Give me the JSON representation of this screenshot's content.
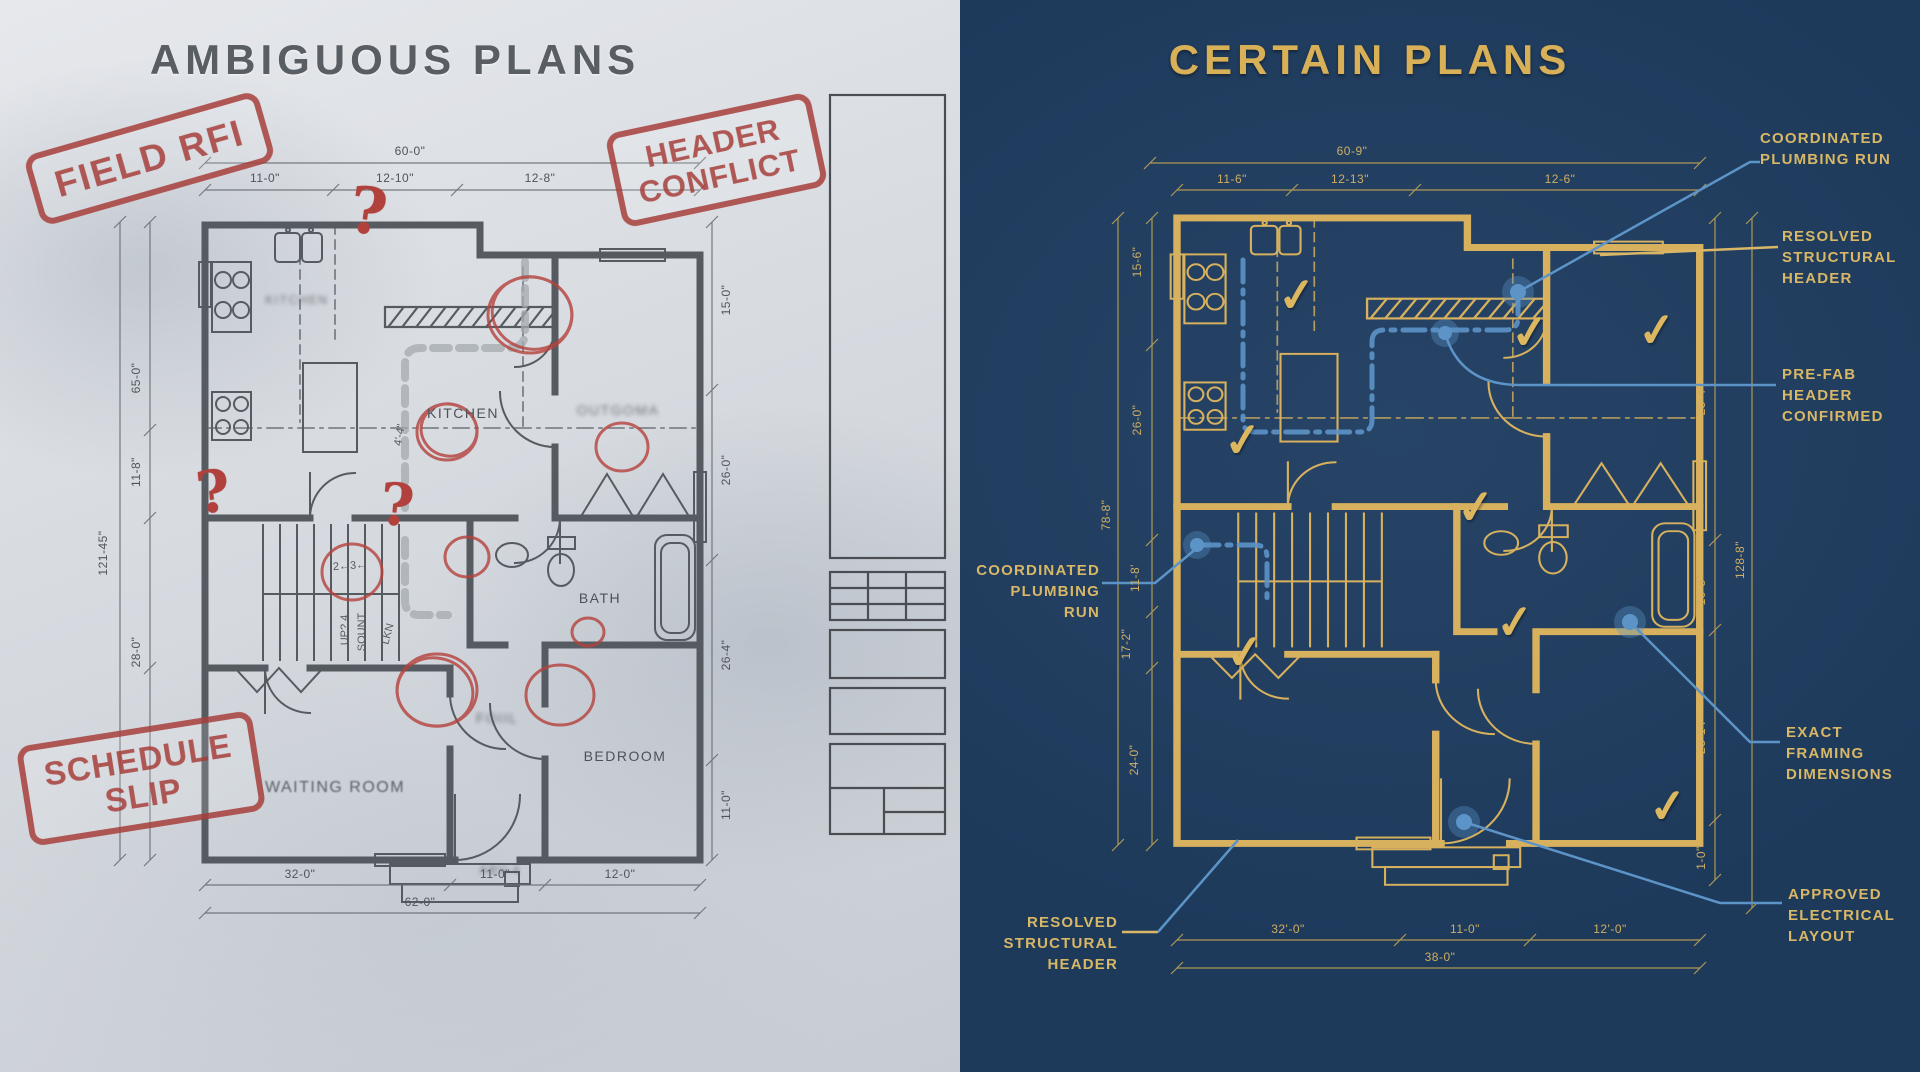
{
  "colors": {
    "navy": "#1e3a5b",
    "gold": "#d8b15e",
    "blue_accent": "#5d94c8",
    "stamp_red": "#a8403c",
    "graphite": "#565b61"
  },
  "left": {
    "title": "AMBIGUOUS PLANS",
    "stamps": {
      "field_rfi": "FIELD RFI",
      "header_conflict": [
        "HEADER",
        "CONFLICT"
      ],
      "schedule_slip": [
        "SCHEDULE",
        "SLIP"
      ]
    },
    "rooms": {
      "kitchen_small": "KITCHEN",
      "kitchen": "KITCHEN",
      "smudged_room": "OUTGOMA",
      "bath": "BATH",
      "bedroom": "BEDROOM",
      "waiting_room": "WAITING ROOM",
      "foyer_smudged": "FOIIL",
      "porch_smudged": "ABV-4"
    },
    "notes": {
      "q": "?",
      "seq_note": "2←3←",
      "stair_note_1": "UP? 4",
      "stair_note_2": "SOUNT",
      "closet_note": "LKN",
      "angle_note": "4'-4\""
    },
    "dims": {
      "top_total": "60-0\"",
      "top_segs": [
        "11-0\"",
        "12-10\"",
        "12-8\""
      ],
      "left_side": [
        "65-0\"",
        "11-8\"",
        "28-0\"",
        "121-45\""
      ],
      "right_side": [
        "15-0\"",
        "26-0\"",
        "26-4\"",
        "11-0\""
      ],
      "bottom_segs": [
        "32-0\"",
        "11-0\"",
        "12-0\""
      ],
      "bottom_total": "62-0\""
    }
  },
  "right": {
    "title": "CERTAIN PLANS",
    "check": "✓",
    "callouts": {
      "plumbing_top": [
        "COORDINATED",
        "PLUMBING RUN"
      ],
      "resolved_header_right": [
        "RESOLVED",
        "STRUCTURAL",
        "HEADER"
      ],
      "prefab": [
        "PRE-FAB",
        "HEADER",
        "CONFIRMED"
      ],
      "framing": [
        "EXACT",
        "FRAMING",
        "DIMENSIONS"
      ],
      "electrical": [
        "APPROVED",
        "ELECTRICAL",
        "LAYOUT"
      ],
      "plumbing_left": [
        "COORDINATED",
        "PLUMBING",
        "RUN"
      ],
      "resolved_header_bottom": [
        "RESOLVED",
        "STRUCTURAL",
        "HEADER"
      ]
    },
    "dims": {
      "top_total": "60-9\"",
      "top_segs": [
        "11-6\"",
        "12-13\"",
        "12-6\""
      ],
      "left_outer": "78-8\"",
      "left_side": [
        "15-6\"",
        "26-0\"",
        "11-8'",
        "17-2\"",
        "24-0\""
      ],
      "right_side": [
        "25-4\"",
        "10-8\"",
        "23-14\"",
        "1-0\""
      ],
      "right_outer": "128-8\"",
      "bottom_segs": [
        "32'-0\"",
        "11-0\"",
        "12'-0\""
      ],
      "bottom_total": "38-0\""
    }
  }
}
